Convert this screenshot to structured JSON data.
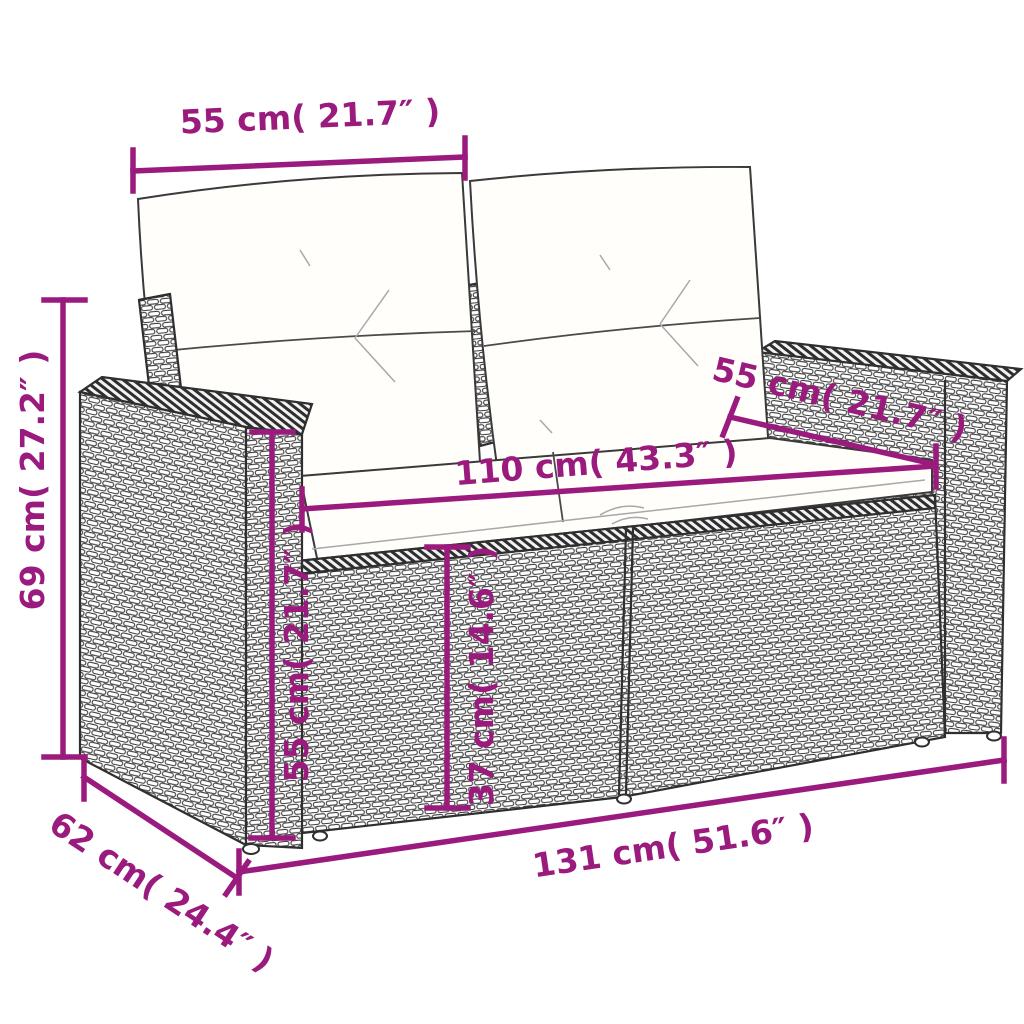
{
  "diagram": {
    "subject": "wicker-two-seater-garden-sofa-with-cushions",
    "style": {
      "accent_color": "#9a1b7d",
      "outline_color": "#2f2f2f",
      "cushion_color": "#fffefb",
      "background": "#ffffff"
    },
    "dimensions": {
      "backrest_width": {
        "label": "55 cm( 21.7″ )"
      },
      "overall_height": {
        "label": "69 cm( 27.2″ )"
      },
      "armrest_depth": {
        "label": "55 cm( 21.7″ )"
      },
      "seat_width": {
        "label": "110 cm( 43.3″ )"
      },
      "armrest_height": {
        "label": "55 cm( 21.7″ )"
      },
      "seat_height": {
        "label": "37 cm( 14.6″ )"
      },
      "overall_width": {
        "label": "131 cm( 51.6″ )"
      },
      "overall_depth": {
        "label": "62 cm( 24.4″ )"
      }
    }
  }
}
